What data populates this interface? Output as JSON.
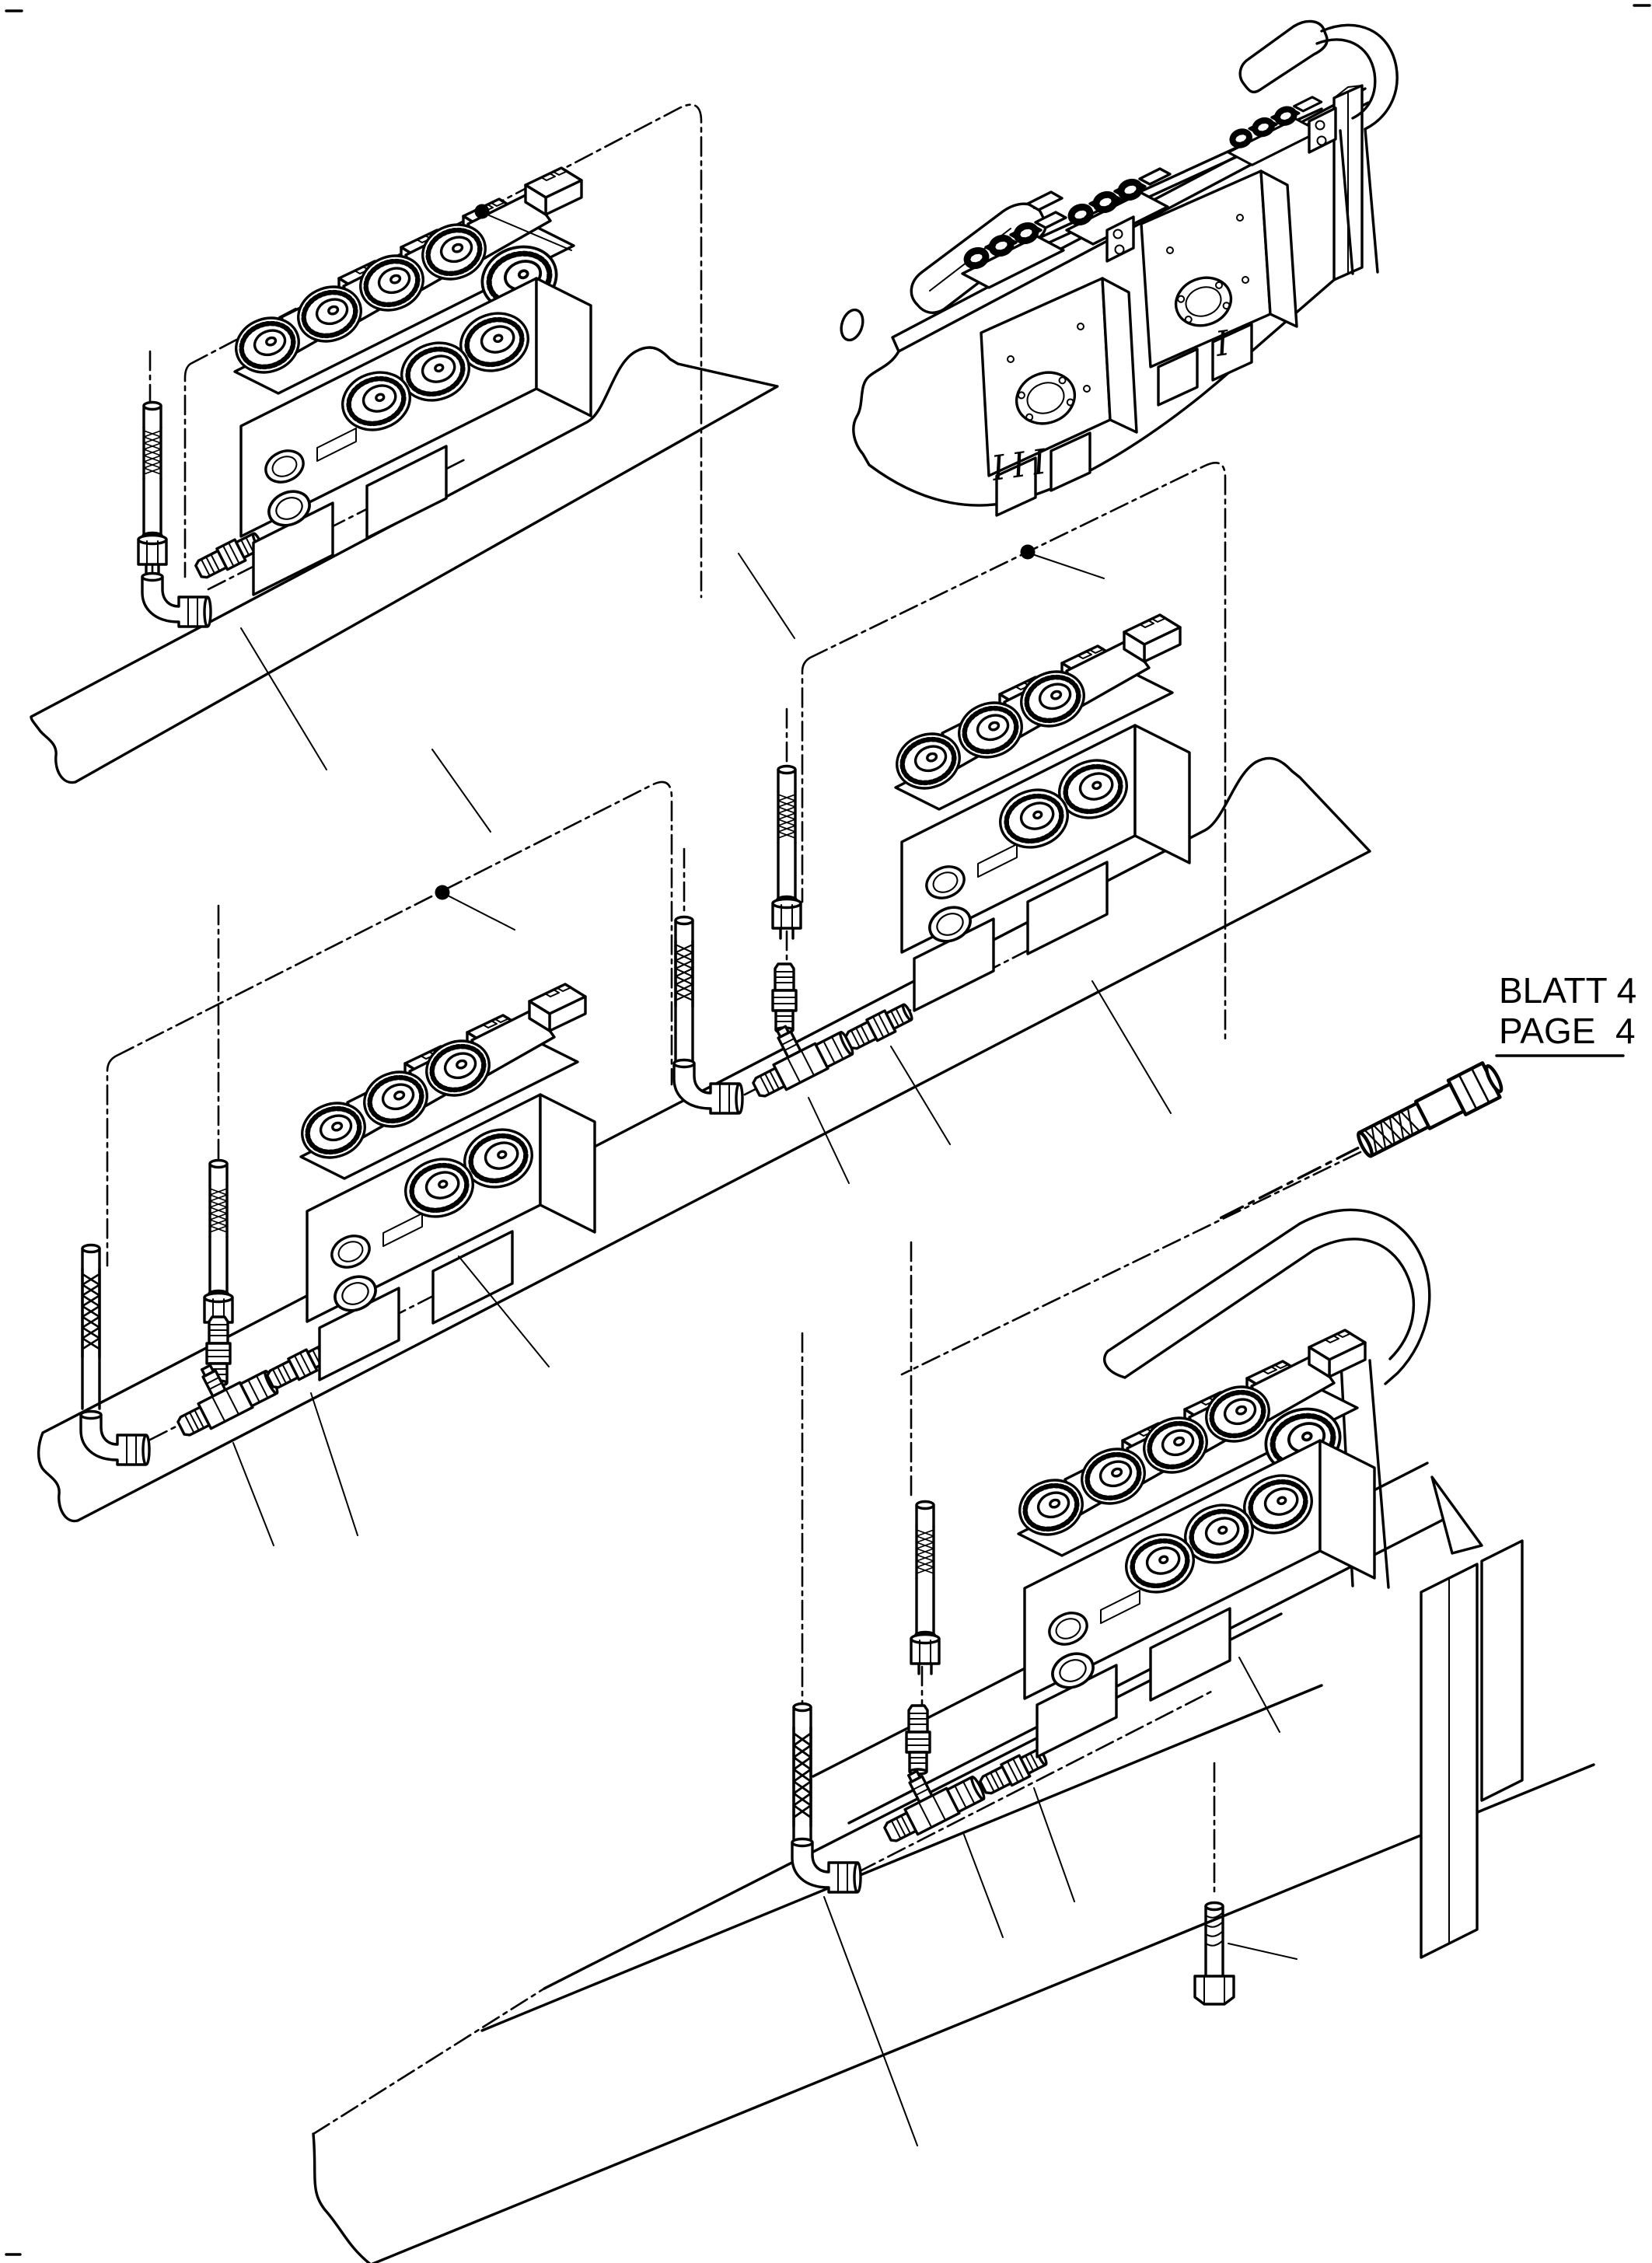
{
  "sheet": {
    "label_de": "BLATT 4",
    "label_en": "PAGE  4"
  },
  "overview_markers": {
    "group_iii": "III",
    "group_i": "I"
  },
  "colors": {
    "ink": "#000000",
    "paper": "#ffffff"
  },
  "drawing": {
    "type": "exploded-parts-diagram",
    "subject": "solenoid-valve-bank-mounting-with-hydraulic-hoses",
    "assemblies": [
      {
        "name": "valve-bank-assembly-top-left",
        "parts": [
          "mounting-panel-phantom",
          "solenoid-valve-bank-4x",
          "braided-hose",
          "elbow-fitting",
          "straight-fitting",
          "callout-dot"
        ]
      },
      {
        "name": "machine-overview-top-right",
        "parts": [
          "frame-plate",
          "control-lever-left",
          "control-lever-right",
          "linkage-rod",
          "valve-manifold-1",
          "valve-manifold-2",
          "solenoid-clusters",
          "frame-post"
        ]
      },
      {
        "name": "valve-bank-assembly-middle-left",
        "parts": [
          "mounting-panel-phantom",
          "solenoid-valve-bank-3x",
          "braided-hose-long",
          "braided-hose",
          "elbow-fitting",
          "tee-fitting",
          "vertical-nipple",
          "straight-fitting",
          "callout-dot"
        ]
      },
      {
        "name": "valve-bank-assembly-middle-right",
        "parts": [
          "mounting-panel-phantom",
          "solenoid-valve-bank-3x",
          "braided-hose",
          "braided-hose",
          "elbow-fitting",
          "tee-fitting",
          "vertical-nipple",
          "straight-fitting",
          "callout-dot",
          "hose-continuation-to-page-4"
        ]
      },
      {
        "name": "valve-bank-assembly-bottom",
        "parts": [
          "mounting-plate",
          "frame-columns",
          "handle-bracket",
          "solenoid-valve-bank-4x",
          "braided-hose",
          "braided-hose",
          "elbow-fitting",
          "tee-fitting",
          "vertical-nipple",
          "straight-fitting",
          "hex-bolt"
        ]
      }
    ]
  }
}
